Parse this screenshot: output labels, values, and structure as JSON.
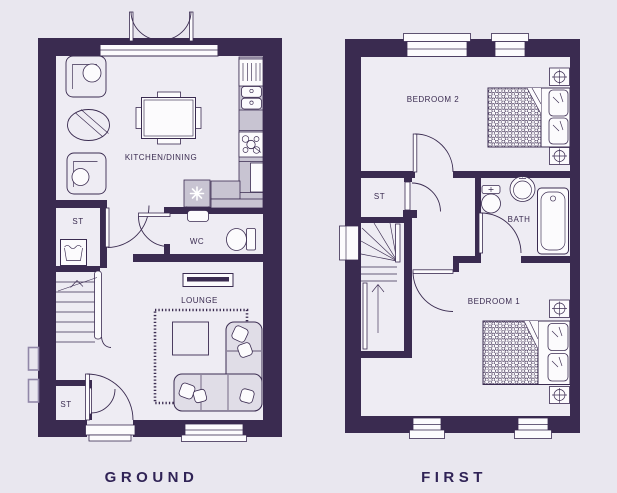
{
  "colors": {
    "wall": "#3a2b50",
    "floor": "#eeecf3",
    "counter": "#c8c4d2",
    "sofa": "#e0dde7",
    "fixture": "#fcfbfd",
    "title": "#302356",
    "light": "#9187a8",
    "background": "#e9e7ef"
  },
  "icons": {
    "freezer": "snowflake-asterisk",
    "washer": "laundry-tub",
    "bedside_lamp": "circle-cross",
    "stairs": "direction-arrow"
  },
  "plans": {
    "ground": {
      "title": "GROUND",
      "labels": {
        "kitchen_dining": "KITCHEN/DINING",
        "wc": "WC",
        "lounge": "LOUNGE",
        "store_upper": "ST",
        "store_lower": "ST"
      }
    },
    "first": {
      "title": "FIRST",
      "labels": {
        "bedroom2": "BEDROOM 2",
        "bedroom1": "BEDROOM 1",
        "bath": "BATH",
        "store": "ST"
      }
    }
  }
}
